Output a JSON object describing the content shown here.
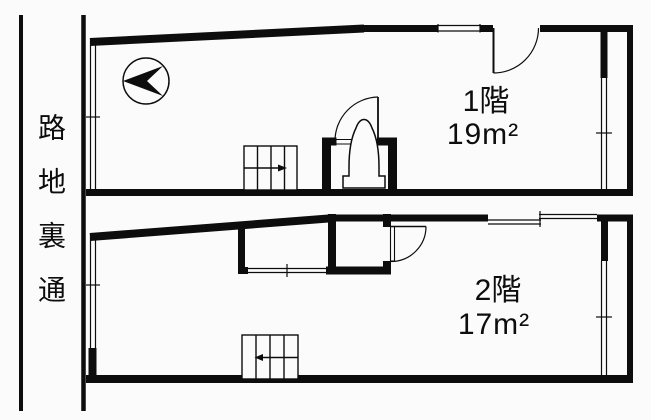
{
  "canvas": {
    "background_color": "#fbfbfb",
    "line_color": "#0d0d0d"
  },
  "road": {
    "label": "路地裏通"
  },
  "floors": [
    {
      "id": "1F",
      "label": "1階",
      "area": "19m²"
    },
    {
      "id": "2F",
      "label": "2階",
      "area": "17m²"
    }
  ],
  "icons": {
    "compass": "north-arrow-icon",
    "toilet": "toilet-icon",
    "stairs_first_floor": "stairs-up-arrow-right",
    "stairs_second_floor": "stairs-down-arrow-left"
  }
}
